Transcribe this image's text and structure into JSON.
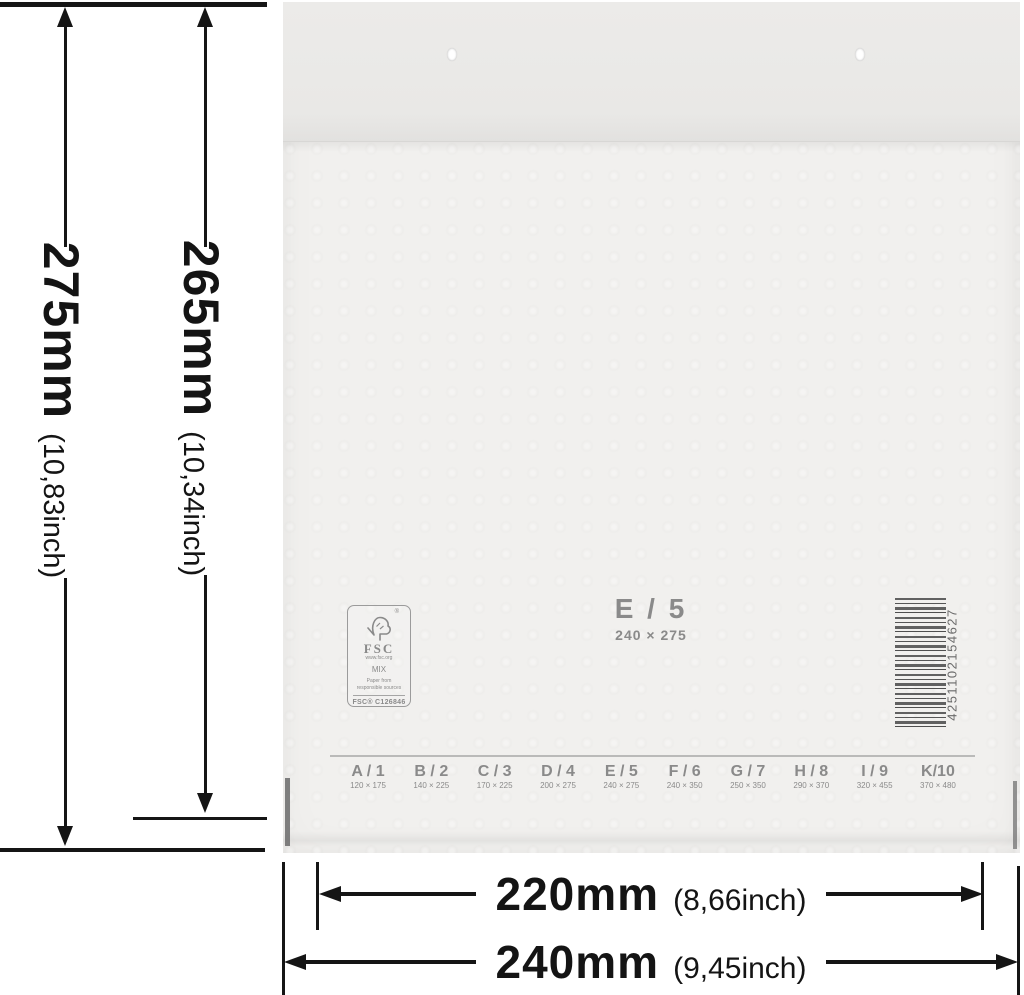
{
  "dims": {
    "outer_height": {
      "mm": "275mm",
      "inch": "(10,83inch)"
    },
    "inner_height": {
      "mm": "265mm",
      "inch": "(10,34inch)"
    },
    "inner_width": {
      "mm": "220mm",
      "inch": "(8,66inch)"
    },
    "outer_width": {
      "mm": "240mm",
      "inch": "(9,45inch)"
    }
  },
  "envelope": {
    "size_code": "E / 5",
    "size_mm": "240 × 275",
    "fsc_label": {
      "brand": "FSC",
      "registered": "®",
      "url": "www.fsc.org",
      "grade": "MIX",
      "tagline_line1": "Paper from",
      "tagline_line2": "responsible sources",
      "license": "FSC® C126846"
    },
    "barcode": {
      "number": "4251102154627"
    },
    "size_chart": [
      {
        "code": "A / 1",
        "size": "120 × 175"
      },
      {
        "code": "B / 2",
        "size": "140 × 225"
      },
      {
        "code": "C / 3",
        "size": "170 × 225"
      },
      {
        "code": "D / 4",
        "size": "200 × 275"
      },
      {
        "code": "E / 5",
        "size": "240 × 275"
      },
      {
        "code": "F / 6",
        "size": "240 × 350"
      },
      {
        "code": "G / 7",
        "size": "250 × 350"
      },
      {
        "code": "H / 8",
        "size": "290 × 370"
      },
      {
        "code": "I / 9",
        "size": "320 × 455"
      },
      {
        "code": "K/10",
        "size": "370 × 480"
      }
    ]
  },
  "colors": {
    "print_gray": "#8a8a8a",
    "dimension_ink": "#151515",
    "envelope_body": "#f1f0ee",
    "envelope_flap": "#e9e8e6"
  }
}
